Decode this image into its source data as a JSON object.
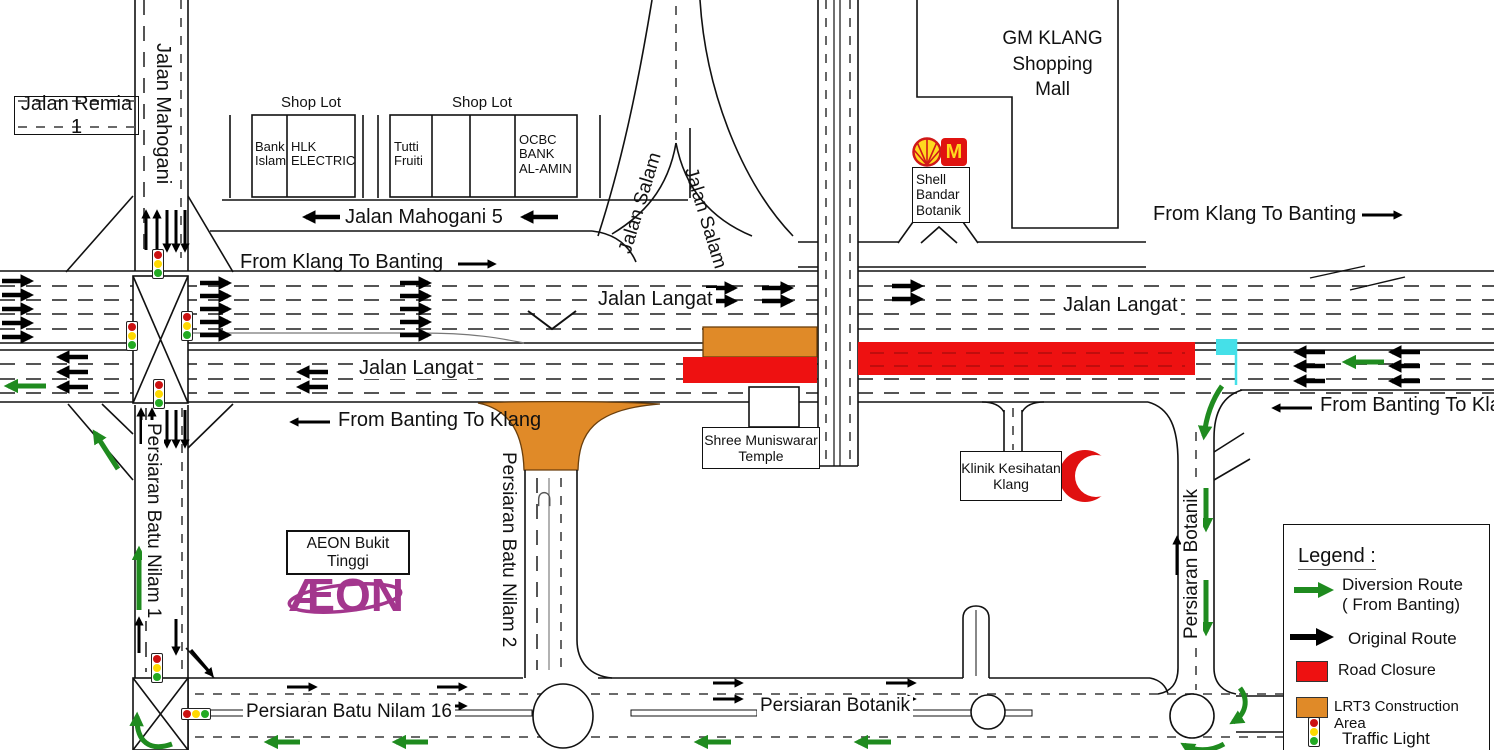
{
  "colors": {
    "road_closure": "#EE1111",
    "construction": "#E08A28",
    "diversion_green": "#1F8B1F",
    "original_black": "#000000",
    "flag_cyan": "#45E0E8",
    "aeon_purple": "#A3368D",
    "crescent_red": "#E01010",
    "mcd_red": "#E01310",
    "shell_yellow": "#FFD91F"
  },
  "labels": {
    "jalan_remia_1": "Jalan Remia 1",
    "jalan_mahogani": "Jalan Mahogani",
    "jalan_mahogani_5": "Jalan Mahogani 5",
    "from_klang_to_banting_left": "From Klang To Banting",
    "from_klang_to_banting_right": "From Klang To Banting",
    "from_banting_to_klang_left": "From Banting To Klang",
    "from_banting_to_klang_right": "From Banting To Klang",
    "jalan_langat_east_left": "Jalan Langat",
    "jalan_langat_west": "Jalan Langat",
    "jalan_langat_east_right": "Jalan Langat",
    "jalan_salam_left": "Jalan Salam",
    "jalan_salam_right": "Jalan Salam",
    "persiaran_batu_nilam_1": "Persiaran Batu Nilam 1",
    "persiaran_batu_nilam_2": "Persiaran Batu Nilam 2",
    "persiaran_batu_nilam_16": "Persiaran Batu Nilam 16",
    "persiaran_botanik_bottom": "Persiaran Botanik",
    "persiaran_botanik_right": "Persiaran Botanik"
  },
  "places": {
    "gm_klang": "GM KLANG\nShopping\nMall",
    "shell_station": "Shell\nBandar\nBotanik",
    "mcdonalds_m": "M",
    "shree_temple": "Shree Muniswarar\nTemple",
    "klinik": "Klinik Kesihatan\nKlang",
    "aeon_sign": "AEON Bukit Tinggi",
    "aeon_logo": "ÆON"
  },
  "shops": {
    "lot_a_title": "Shop Lot",
    "lot_b_title": "Shop Lot",
    "block_a": {
      "cells": [
        "Bank\nIslam",
        "HLK\nELECTRIC"
      ]
    },
    "block_b": {
      "cells": [
        "Tutti\nFruiti",
        "",
        "",
        "OCBC\nBANK\nAL-AMIN"
      ]
    }
  },
  "icons": {
    "u_turn": "∩"
  },
  "legend": {
    "title": "Legend :",
    "items": [
      {
        "id": "diversion-route",
        "label": "Diversion Route\n( From Banting)"
      },
      {
        "id": "original-route",
        "label": "Original Route"
      },
      {
        "id": "road-closure",
        "label": "Road Closure"
      },
      {
        "id": "lrt3-construction",
        "label": "LRT3 Construction Area"
      },
      {
        "id": "traffic-light",
        "label": "Traffic Light"
      }
    ]
  }
}
